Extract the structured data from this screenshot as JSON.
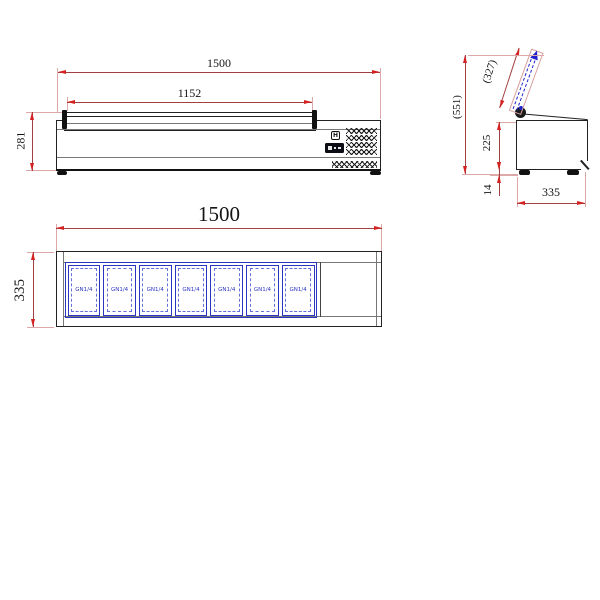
{
  "front_view": {
    "dims": {
      "total_width": "1500",
      "glass_width": "1152",
      "height": "281"
    },
    "controller": {
      "logo": "H"
    }
  },
  "side_view": {
    "dims": {
      "lid_length": "(327)",
      "open_height": "(551)",
      "body_height": "225",
      "foot_height": "14",
      "depth": "335"
    }
  },
  "plan_view": {
    "dims": {
      "total_width": "1500",
      "depth": "335"
    },
    "pans": [
      {
        "label": "GN1/4"
      },
      {
        "label": "GN1/4"
      },
      {
        "label": "GN1/4"
      },
      {
        "label": "GN1/4"
      },
      {
        "label": "GN1/4"
      },
      {
        "label": "GN1/4"
      },
      {
        "label": "GN1/4"
      }
    ]
  },
  "colors": {
    "outline": "#222222",
    "dimension_line": "#a04040",
    "arrow": "#d42222",
    "pan_blue": "#2a35c0",
    "lid_arrow_blue": "#2222cc"
  }
}
